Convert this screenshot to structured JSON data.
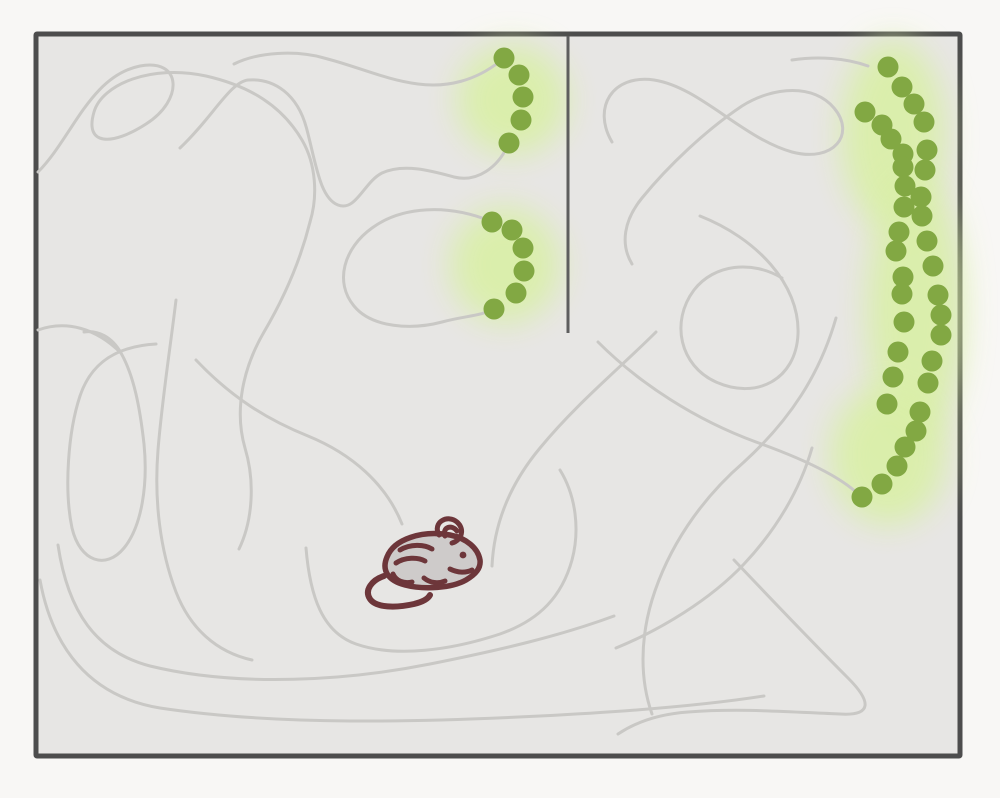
{
  "scene": {
    "description": "Top-down schematic of a mouse in a rectangular walled arena; thin gray lines trace its exploration trajectory, glowing arcs of green pellet dots mark odor/reward trails, and a short divider wall hangs from the top wall.",
    "colors": {
      "page_background": "#f8f7f5",
      "arena_floor": "#e7e6e4",
      "arena_wall": "#4d4d4d",
      "divider_wall": "#5e5e5e",
      "trajectory_line": "#c9c8c5",
      "pellet_green": "#82a843",
      "pellet_glow": "#d9efa6",
      "mouse_outline": "#6d363a",
      "mouse_body": "#cecbca"
    },
    "arena": {
      "x": 36,
      "y": 34,
      "width": 924,
      "height": 722,
      "wall_thickness": 5
    },
    "divider": {
      "x": 568,
      "y_top": 36,
      "y_bottom": 333,
      "thickness": 3
    }
  },
  "glows": [
    {
      "cx": 512,
      "cy": 100,
      "rx": 55,
      "ry": 55
    },
    {
      "cx": 505,
      "cy": 265,
      "rx": 55,
      "ry": 58
    },
    {
      "cx": 893,
      "cy": 135,
      "rx": 52,
      "ry": 95
    },
    {
      "cx": 915,
      "cy": 310,
      "rx": 48,
      "ry": 135
    },
    {
      "cx": 888,
      "cy": 455,
      "rx": 58,
      "ry": 70
    }
  ],
  "trails": {
    "stroke_width": 3,
    "paths": [
      "M 38 172 C 72 138 90 76 140 66 C 182 58 184 100 146 124 C 112 146 84 146 94 112 C 102 84 152 64 206 76 C 250 86 282 106 302 140 C 316 164 318 196 310 222",
      "M 180 148 C 212 118 230 82 248 80 C 274 78 298 94 307 130 C 316 164 320 198 338 205 C 356 212 364 182 382 173 C 404 163 432 171 454 177 C 478 183 498 166 507 147",
      "M 499 62 C 476 80 448 88 418 84 C 386 80 356 66 324 58 C 296 50 258 52 234 64",
      "M 490 221 C 448 204 402 206 372 228 C 344 248 334 282 354 306 C 372 328 412 330 442 322 C 464 316 482 316 493 309",
      "M 310 222 C 300 262 284 298 264 332 C 243 368 234 410 245 448 C 255 481 253 520 239 549",
      "M 156 344 C 120 346 92 360 80 396 C 68 432 64 490 72 528 C 80 562 106 570 124 548 C 142 526 148 484 144 444 C 140 408 134 376 121 353 C 112 337 98 330 84 332",
      "M 176 300 C 170 350 162 400 158 450 C 154 500 160 550 176 592 C 190 628 216 652 252 660",
      "M 196 360 C 232 398 268 420 308 436 C 352 454 386 484 402 524",
      "M 306 548 C 310 596 322 632 356 644 C 396 658 452 650 500 634 C 540 620 562 596 572 560 C 580 530 576 496 560 470",
      "M 58 545 C 68 612 96 652 150 666 C 240 688 350 680 430 664 C 500 650 560 636 614 616",
      "M 40 580 C 52 646 88 696 160 708 C 280 726 420 722 540 716 C 620 712 700 706 764 696",
      "M 734 560 C 772 600 818 648 848 678 C 872 702 872 716 840 714 C 790 712 740 708 688 712 C 660 714 636 722 618 734",
      "M 616 648 C 660 630 710 600 744 564 C 776 530 800 490 812 448",
      "M 598 342 C 640 384 696 420 756 442 C 812 462 846 480 862 498",
      "M 836 318 C 820 374 790 420 744 462 C 700 500 668 548 652 600 C 640 640 640 680 652 714",
      "M 612 142 C 592 108 612 74 654 80 C 700 87 742 138 792 152 C 834 163 856 134 834 108 C 814 84 774 86 742 106 C 706 130 668 166 642 198 C 624 220 620 244 632 264",
      "M 700 216 C 756 238 800 284 798 334 C 796 380 756 400 716 382 C 680 366 670 322 694 290 C 714 264 752 260 782 278",
      "M 792 60 C 818 56 846 58 868 66",
      "M 656 332 C 620 368 576 404 540 448 C 510 484 494 524 492 566",
      "M 38 330 C 66 320 96 328 121 353"
    ]
  },
  "pellets": {
    "radius": 10.5,
    "clusters": [
      {
        "name": "top-center-arc",
        "count": 5,
        "dots": [
          [
            504,
            58
          ],
          [
            519,
            75
          ],
          [
            523,
            97
          ],
          [
            521,
            120
          ],
          [
            509,
            143
          ]
        ]
      },
      {
        "name": "mid-center-arc",
        "count": 6,
        "dots": [
          [
            492,
            222
          ],
          [
            512,
            230
          ],
          [
            523,
            248
          ],
          [
            524,
            271
          ],
          [
            516,
            293
          ],
          [
            494,
            309
          ]
        ]
      },
      {
        "name": "right-wall-arc",
        "count": 36,
        "dots": [
          [
            888,
            67
          ],
          [
            902,
            87
          ],
          [
            914,
            104
          ],
          [
            865,
            112
          ],
          [
            882,
            125
          ],
          [
            924,
            122
          ],
          [
            891,
            139
          ],
          [
            903,
            154
          ],
          [
            927,
            150
          ],
          [
            903,
            167
          ],
          [
            925,
            170
          ],
          [
            905,
            186
          ],
          [
            921,
            197
          ],
          [
            904,
            207
          ],
          [
            922,
            216
          ],
          [
            899,
            232
          ],
          [
            927,
            241
          ],
          [
            896,
            251
          ],
          [
            933,
            266
          ],
          [
            903,
            277
          ],
          [
            902,
            294
          ],
          [
            938,
            295
          ],
          [
            941,
            315
          ],
          [
            904,
            322
          ],
          [
            941,
            335
          ],
          [
            898,
            352
          ],
          [
            932,
            361
          ],
          [
            893,
            377
          ],
          [
            928,
            383
          ],
          [
            887,
            404
          ],
          [
            920,
            412
          ],
          [
            916,
            431
          ],
          [
            905,
            447
          ],
          [
            897,
            466
          ],
          [
            882,
            484
          ],
          [
            862,
            497
          ]
        ]
      }
    ]
  },
  "mouse": {
    "x": 362,
    "y": 514,
    "facing": "right"
  }
}
